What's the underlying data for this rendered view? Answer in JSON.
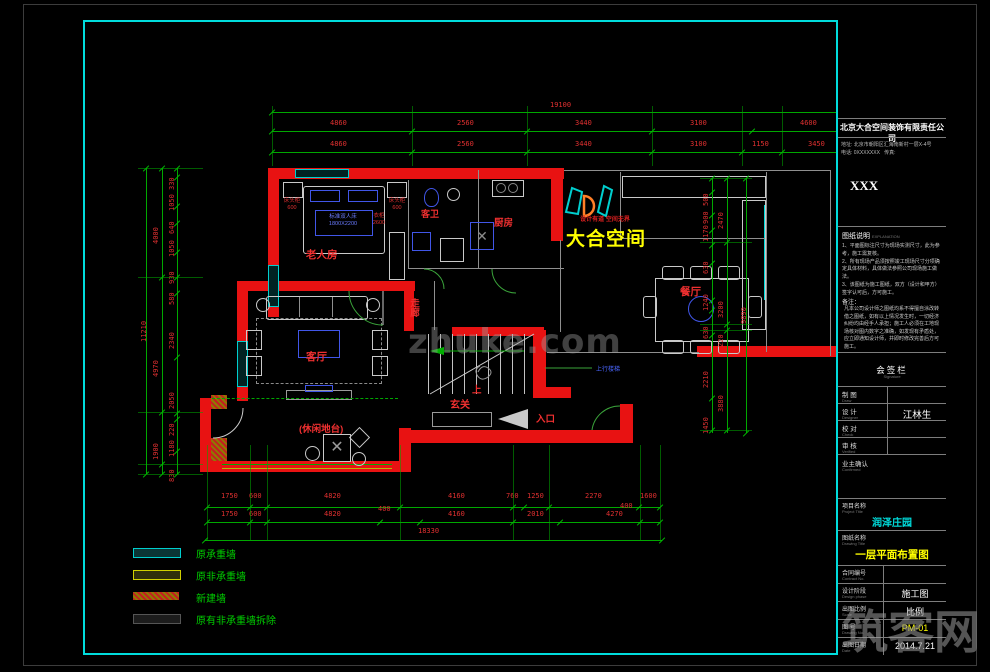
{
  "watermark": {
    "center": "zhuke.com",
    "corner": "筑客网"
  },
  "logo": {
    "slogan": "设计有道 空间无界",
    "name": "大合空间"
  },
  "rooms": {
    "elder_bedroom": "老人房",
    "living": "客厅",
    "dining": "餐厅",
    "kitchen": "厨房",
    "guest_bath": "客卫",
    "corridor": "走廊",
    "entry": "玄关",
    "leisure": "(休闲地台)",
    "up": "上",
    "entrance": "入口",
    "stair_note": "上行楼梯"
  },
  "furniture": {
    "bed_line1": "标准双人床",
    "bed_line2": "1800X2200",
    "nightstand": "床头柜",
    "nightstand_size": "600",
    "wardrobe": "衣柜",
    "wardrobe_size": "2600"
  },
  "legend": {
    "items": [
      {
        "label": "原承重墙"
      },
      {
        "label": "原非承重墙"
      },
      {
        "label": "新建墙"
      },
      {
        "label": "原有非承重墙拆除"
      }
    ]
  },
  "dims": {
    "top": {
      "total": "19100",
      "row2": [
        "4860",
        "2560",
        "3440",
        "3100",
        "4600"
      ],
      "row3": [
        "4860",
        "2560",
        "3440",
        "3100",
        "1150",
        "3450"
      ]
    },
    "bottom": {
      "row1": [
        "1750",
        "600",
        "4820",
        "4160",
        "760",
        "1250",
        "2270",
        "1600"
      ],
      "row2": [
        "1750",
        "600",
        "4820",
        "400",
        "4160",
        "2010",
        "4270",
        "400"
      ],
      "total": "18330"
    },
    "left": {
      "outer": "11210",
      "mid": [
        "4000",
        "4970",
        "1900"
      ],
      "inner": [
        "330",
        "1050",
        "640",
        "1050",
        "930",
        "580",
        "2340",
        "2050",
        "220",
        "1180",
        "830"
      ]
    },
    "right": {
      "outer": "9890",
      "mid": [
        "2470",
        "3200",
        "220",
        "3880"
      ],
      "inner": [
        "500",
        "900",
        "1170",
        "630",
        "1240",
        "630",
        "2210",
        "1450"
      ]
    }
  },
  "title_block": {
    "company": "北京大合空间装饰有限责任公司",
    "address": "地址: 北京市朝阳区汇海南新村一层X-4号",
    "phone": "电话: 0XXXXXXX",
    "fax": "传真:",
    "code": "XXX",
    "explanation_title": "图纸说明",
    "explanation_title_en": "EXPLANATION",
    "notes": [
      "1、平面图标注尺寸为现场实测尺寸，此为参考，施工需复核。",
      "2、所有现场产品须按照竣工现场尺寸分项确定具体材料，具体做法参照公司现场施工做法。",
      "3、该图纸为施工图纸，双方（设计和甲方）签字认可后，方可施工。"
    ],
    "remark_title": "备注：",
    "remark": "凡本公司设计师之图纸均系不得擅自涂改转借之图纸，如有以上情况发生时，一切经济纠纷均由经手人承担；施工人必须在工地现场核对图内数字之准确，如发现有矛盾处，应立即通知设计师，并即时修改完善后方可施工。",
    "sign_title": "会签栏",
    "sign_title_en": "Signature",
    "rows": [
      {
        "label": "制 图",
        "en": "Draw",
        "value": ""
      },
      {
        "label": "设 计",
        "en": "Designer",
        "value": "江林生"
      },
      {
        "label": "校 对",
        "en": "Check",
        "value": ""
      },
      {
        "label": "审 核",
        "en": "Verified",
        "value": ""
      }
    ],
    "owner": "业主确认",
    "owner_en": "Confirmed",
    "project_label": "项目名称",
    "project_label_en": "Project Title",
    "project": "润泽庄园",
    "drawing_label": "图纸名称",
    "drawing_label_en": "Drawing Title",
    "drawing": "一层平面布置图",
    "contract_label": "合同编号",
    "contract_en": "Contract No.",
    "contract": "",
    "phase_label": "设计阶段",
    "phase_en": "Design phase",
    "phase": "施工图",
    "scale_label": "出图比例",
    "scale_en": "Scale",
    "scale": "比例",
    "no_label": "图 号",
    "no_en": "Drawing No.",
    "no": "PM-01",
    "date_label": "出图日期",
    "date_en": "Date",
    "date": "2014.7.21"
  }
}
